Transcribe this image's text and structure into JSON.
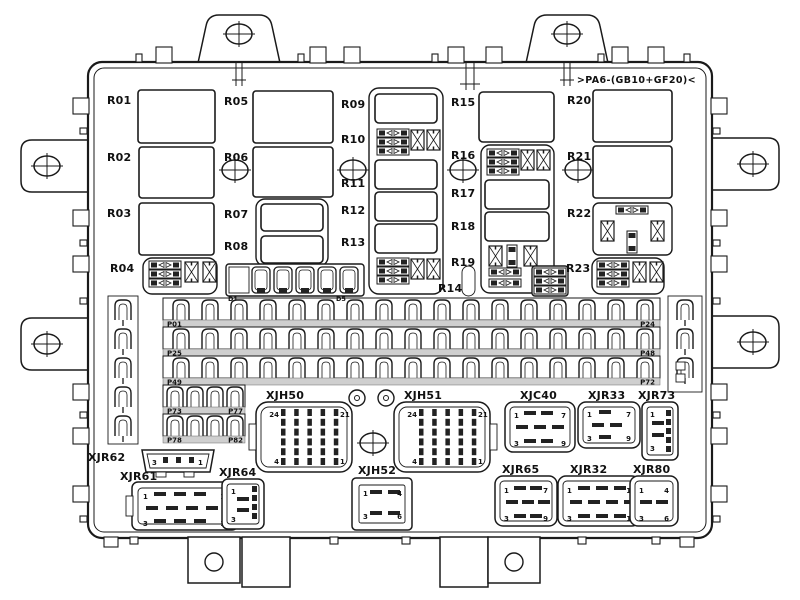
{
  "part_marking": ">PA6-(GB10+GF20)<",
  "relays": [
    "R01",
    "R02",
    "R03",
    "R04",
    "R05",
    "R06",
    "R07",
    "R08",
    "R09",
    "R10",
    "R11",
    "R12",
    "R13",
    "R14",
    "R15",
    "R16",
    "R17",
    "R18",
    "R19",
    "R20",
    "R21",
    "R22",
    "R23"
  ],
  "fuse_rows": [
    {
      "left": "P01",
      "right": "P24"
    },
    {
      "left": "P25",
      "right": "P48"
    },
    {
      "left": "P49",
      "right": "P72"
    },
    {
      "left": "P73",
      "right": "P77"
    },
    {
      "left": "P78",
      "right": "P82"
    }
  ],
  "diodes": {
    "first": "D1",
    "last": "D5"
  },
  "connectors": {
    "xjh50": {
      "label": "XJH50",
      "pin_tl": "24",
      "pin_tr": "21",
      "pin_bl": "4",
      "pin_br": "1"
    },
    "xjh51": {
      "label": "XJH51",
      "pin_tl": "24",
      "pin_tr": "21",
      "pin_bl": "4",
      "pin_br": "1"
    },
    "xjh52": {
      "label": "XJH52",
      "pin_tl": "1",
      "pin_tr": "4",
      "pin_bl": "3",
      "pin_br": "6"
    },
    "xjc40": {
      "label": "XJC40",
      "pin_tl": "1",
      "pin_tr": "7",
      "pin_bl": "3",
      "pin_br": "9"
    },
    "xjr33": {
      "label": "XJR33",
      "pin_tl": "1",
      "pin_tr": "7",
      "pin_bl": "3",
      "pin_br": "9"
    },
    "xjr73": {
      "label": "XJR73",
      "pin_top": "1",
      "pin_bottom": "3"
    },
    "xjr65": {
      "label": "XJR65",
      "pin_tl": "1",
      "pin_tr": "7",
      "pin_bl": "3",
      "pin_br": "9"
    },
    "xjr32": {
      "label": "XJR32",
      "pin_tl": "1",
      "pin_tr": "10",
      "pin_bl": "3",
      "pin_br": "12"
    },
    "xjr80": {
      "label": "XJR80",
      "pin_tl": "1",
      "pin_tr": "4",
      "pin_bl": "3",
      "pin_br": "6"
    },
    "xjr62": {
      "label": "XJR62",
      "pin_left": "3",
      "pin_right": "1"
    },
    "xjr61": {
      "label": "XJR61",
      "pin_tl": "1",
      "pin_tr": "10",
      "pin_bl": "3",
      "pin_br": "12"
    },
    "xjr64": {
      "label": "XJR64",
      "pin_top": "1",
      "pin_bottom": "3"
    }
  },
  "colors": {
    "line": "#1a1a1a",
    "band": "#cfcfcf",
    "background": "#ffffff"
  }
}
